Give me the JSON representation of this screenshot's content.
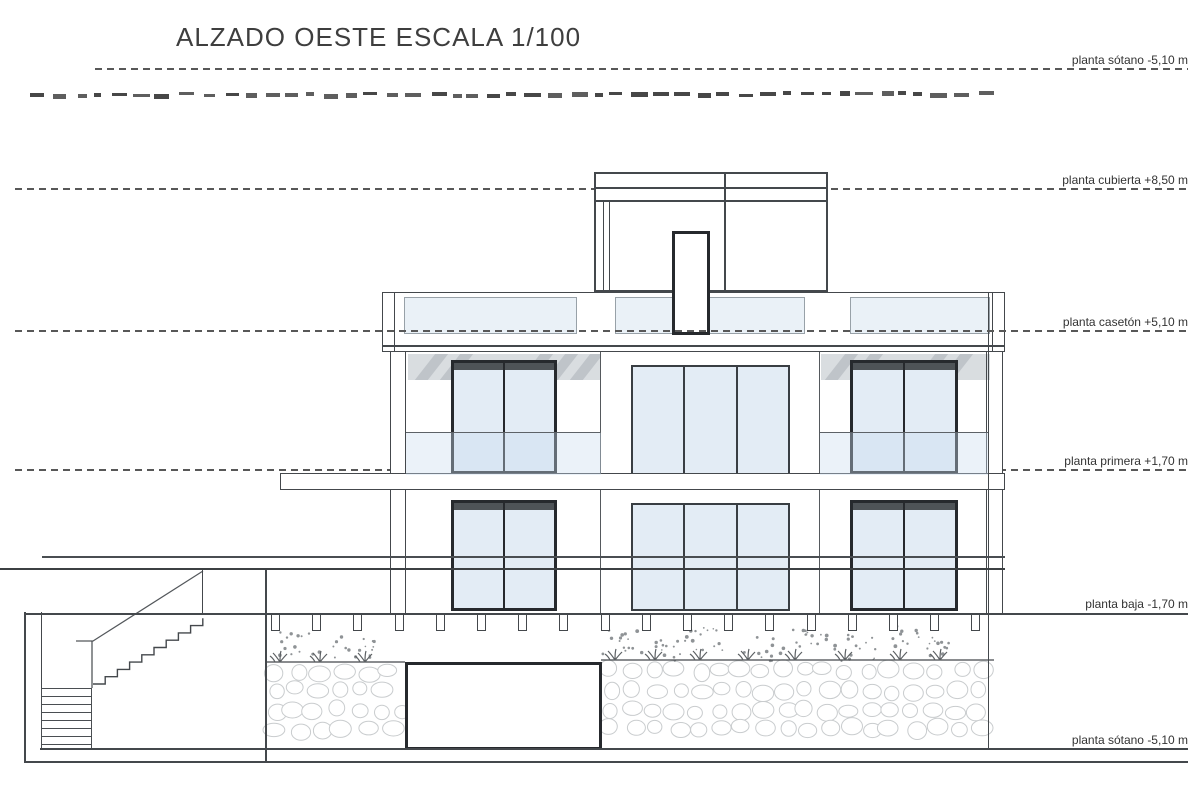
{
  "title": "ALZADO OESTE ESCALA 1/100",
  "drawing": {
    "view": "ALZADO OESTE",
    "scale": "1/100"
  },
  "levels": [
    {
      "name": "planta sótano",
      "elevation": "-5,10 m",
      "label": "planta sótano -5,10 m"
    },
    {
      "name": "planta cubierta",
      "elevation": "+8,50 m",
      "label": "planta cubierta +8,50 m"
    },
    {
      "name": "planta casetón",
      "elevation": "+5,10 m",
      "label": "planta casetón +5,10 m"
    },
    {
      "name": "planta primera",
      "elevation": "+1,70 m",
      "label": "planta primera +1,70 m"
    },
    {
      "name": "planta baja",
      "elevation": "-1,70 m",
      "label": "planta baja -1,70 m"
    },
    {
      "name": "planta sótano",
      "elevation": "-5,10 m",
      "label": "planta sótano -5,10 m"
    }
  ],
  "colors": {
    "line": "#44484c",
    "window_frame": "#26292d",
    "glass": "#e3ecf5",
    "terrace_glass": "#eaf1f7",
    "awning_band": "#d9dde0",
    "dashed_level_line": "#585858",
    "pebble_outline": "#c9ccce",
    "gravel_dot": "#8f9396",
    "label_text": "#333333",
    "title_text": "#3e3e3e"
  }
}
